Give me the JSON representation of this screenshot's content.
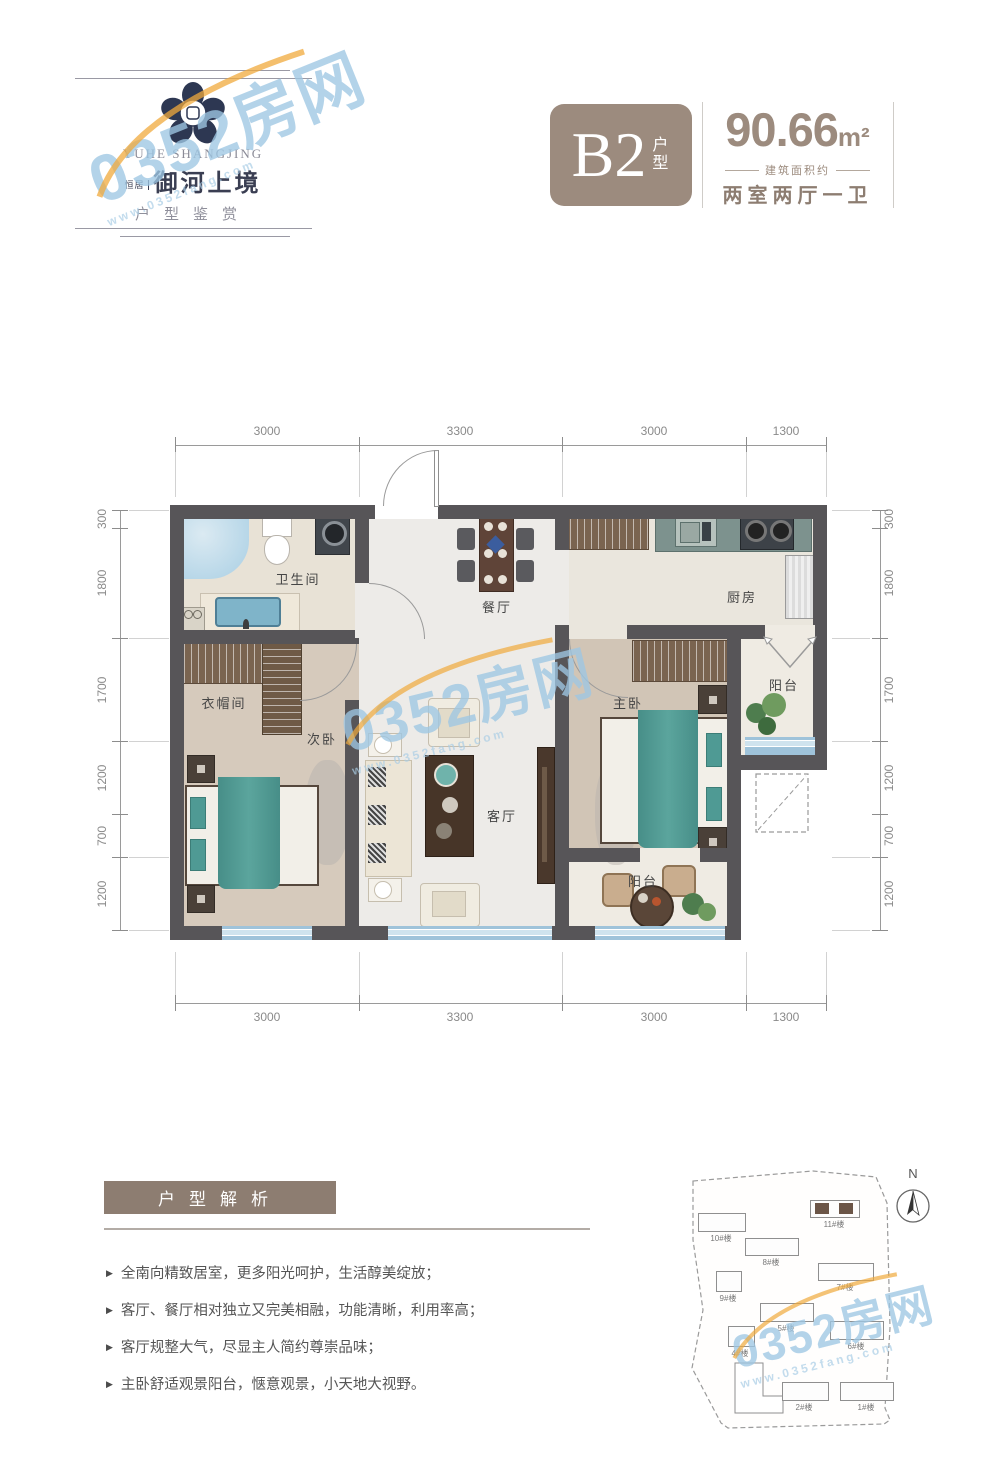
{
  "watermark": {
    "text": "0352房网",
    "subtext": "www.0352fang.com"
  },
  "header": {
    "logo_en": "YUHE SHANGJING",
    "logo_prefix": "恒居",
    "logo_cn": "御河上境",
    "logo_tagline": "户型鉴赏"
  },
  "title": {
    "unit_code": "B2",
    "unit_code_suffix": "户型",
    "area": "90.66",
    "area_unit": "m²",
    "area_note": "建筑面积约",
    "layout_desc": "两室两厅一卫"
  },
  "floorplan": {
    "dims_top": [
      "3000",
      "3300",
      "3000",
      "1300"
    ],
    "dims_bottom": [
      "3000",
      "3300",
      "3000",
      "1300"
    ],
    "dims_left": [
      "300",
      "1800",
      "1700",
      "1200",
      "700",
      "1200"
    ],
    "dims_right": [
      "300",
      "1800",
      "1700",
      "1200",
      "700",
      "1200"
    ],
    "rooms": [
      {
        "id": "bathroom",
        "label": "卫生间"
      },
      {
        "id": "dining",
        "label": "餐厅"
      },
      {
        "id": "kitchen",
        "label": "厨房"
      },
      {
        "id": "cloakroom",
        "label": "衣帽间"
      },
      {
        "id": "second-bedroom",
        "label": "次卧"
      },
      {
        "id": "master-bedroom",
        "label": "主卧"
      },
      {
        "id": "balcony-kitchen",
        "label": "阳台"
      },
      {
        "id": "living-room",
        "label": "客厅"
      },
      {
        "id": "balcony-south",
        "label": "阳台"
      }
    ]
  },
  "analysis": {
    "title": "户型解析",
    "marker": "▶",
    "bullets": [
      "全南向精致居室，更多阳光呵护，生活醇美绽放；",
      "客厅、餐厅相对独立又完美相融，功能清晰，利用率高；",
      "客厅规整大气，尽显主人简约尊崇品味；",
      "主卧舒适观景阳台，惬意观景，小天地大视野。"
    ]
  },
  "siteplan": {
    "north_label": "N",
    "buildings": [
      {
        "label": "10#楼",
        "highlight": false
      },
      {
        "label": "11#楼",
        "highlight": true
      },
      {
        "label": "8#楼",
        "highlight": false
      },
      {
        "label": "7#楼",
        "highlight": false
      },
      {
        "label": "9#楼",
        "highlight": false
      },
      {
        "label": "5#楼",
        "highlight": false
      },
      {
        "label": "6#楼",
        "highlight": false
      },
      {
        "label": "4#楼",
        "highlight": false
      },
      {
        "label": "2#楼",
        "highlight": false
      },
      {
        "label": "1#楼",
        "highlight": false
      }
    ]
  },
  "colors": {
    "accent_taupe": "#9c8b7e",
    "band_brown": "#8d7d71",
    "wall_gray": "#575558",
    "bed_teal": "#4f9a94",
    "window_blue": "#a9cbdf",
    "watermark_blue": "#9ec6e3",
    "watermark_orange": "#f0a93c"
  }
}
